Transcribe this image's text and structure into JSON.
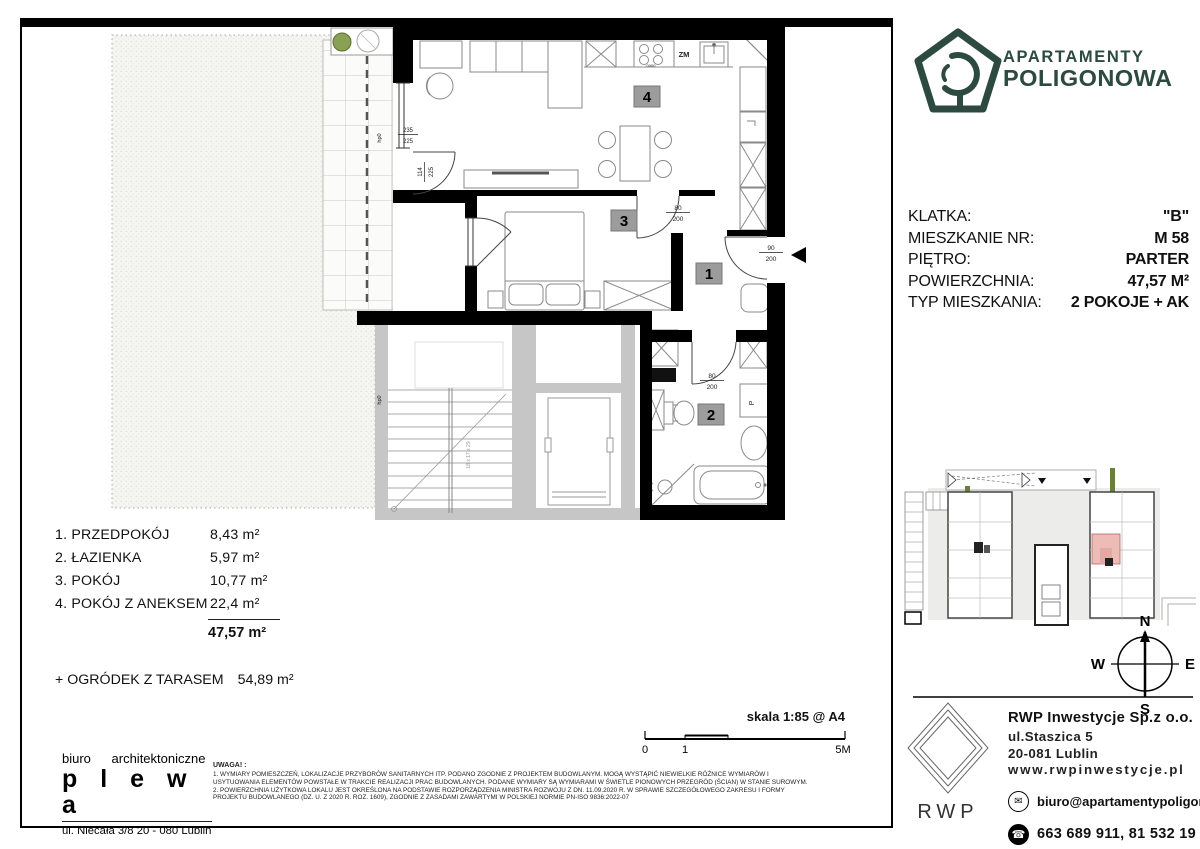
{
  "brand": {
    "line1": "APARTAMENTY",
    "line2": "POLIGONOWA",
    "color": "#2d4a40"
  },
  "details": {
    "rows": [
      {
        "label": "KLATKA:",
        "value": "\"B\""
      },
      {
        "label": "MIESZKANIE NR:",
        "value": "M  58"
      },
      {
        "label": "PIĘTRO:",
        "value": "PARTER"
      },
      {
        "label": "POWIERZCHNIA:",
        "value": "47,57 M²"
      },
      {
        "label": "TYP MIESZKANIA:",
        "value": "2 POKOJE + AK"
      }
    ]
  },
  "room_list": {
    "rows": [
      {
        "name": "1. PRZEDPOKÓJ",
        "area": "8,43 m²"
      },
      {
        "name": "2. ŁAZIENKA",
        "area": "5,97 m²"
      },
      {
        "name": "3. POKÓJ",
        "area": "10,77 m²"
      },
      {
        "name": "4. POKÓJ Z ANEKSEM",
        "area": "22,4 m²"
      }
    ],
    "total": "47,57  m²",
    "garden_label": "+ OGRÓDEK Z TARASEM",
    "garden_area": "54,89  m²"
  },
  "plan": {
    "badge1": "1",
    "badge2": "2",
    "badge3": "3",
    "badge4": "4",
    "zm": "ZM",
    "washer": "P",
    "hob": "0000",
    "sill": "hp0",
    "door_bedroom_top": "80",
    "door_bedroom_bot": "200",
    "door_entry_top": "90",
    "door_entry_bot": "200",
    "door_bath_top": "80",
    "door_bath_bot": "200",
    "win_top": "235",
    "win_bot": "225",
    "balc_top": "114",
    "balc_bot": "225",
    "stairs_note": "18 x 17 x 29"
  },
  "compass": {
    "n": "N",
    "e": "E",
    "s": "S",
    "w": "W"
  },
  "scalebar": {
    "label": "skala 1:85 @ A4",
    "t0": "0",
    "t1": "1",
    "t2": "5M"
  },
  "architect": {
    "line1": "biuro architektoniczne",
    "name": "p l e w a",
    "address": "ul. Niecała 3/8  20 - 080 Lublin"
  },
  "notes": {
    "title": "UWAGA! :",
    "lines": [
      "1. WYMIARY POMIESZCZEŃ, LOKALIZACJE PRZYBORÓW SANITARNYCH ITP. PODANO ZGODNIE Z PROJEKTEM BUDOWLANYM. MOGĄ WYSTĄPIĆ NIEWIELKIE RÓŻNICE WYMIARÓW I",
      "USYTUOWANIA ELEMENTÓW POWSTAŁE W TRAKCIE REALIZACJI PRAC BUDOWLANYCH. PODANE WYMIARY SĄ WYMIARAMI W ŚWIETLE PIONOWYCH PRZEGRÓD (ŚCIAN) W STANIE SUROWYM.",
      "2. POWIERZCHNIA UŻYTKOWA LOKALU JEST OKREŚLONA NA PODSTAWIE ROZPORZĄDZENIA MINISTRA ROZWOJU Z DN. 11.09.2020 R. W SPRAWIE SZCZEGÓŁOWEGO ZAKRESU I FORMY",
      "PROJEKTU BUDOWLANEGO (DZ. U. Z 2020 R. ROZ. 1609), ZGODNIE Z ZASADAMI ZAWARTYMI W POLSKIEJ NORMIE PN-ISO 9836:2022-07"
    ]
  },
  "contact": {
    "company": "RWP Inwestycje Sp.z o.o.",
    "street": "ul.Staszica 5",
    "city": "20-081 Lublin",
    "web": "www.rwpinwestycje.pl",
    "email": "biuro@apartamentypoligonowa.pl",
    "phone": "663 689 911,  81 532 19 66",
    "logo": "RWP"
  }
}
